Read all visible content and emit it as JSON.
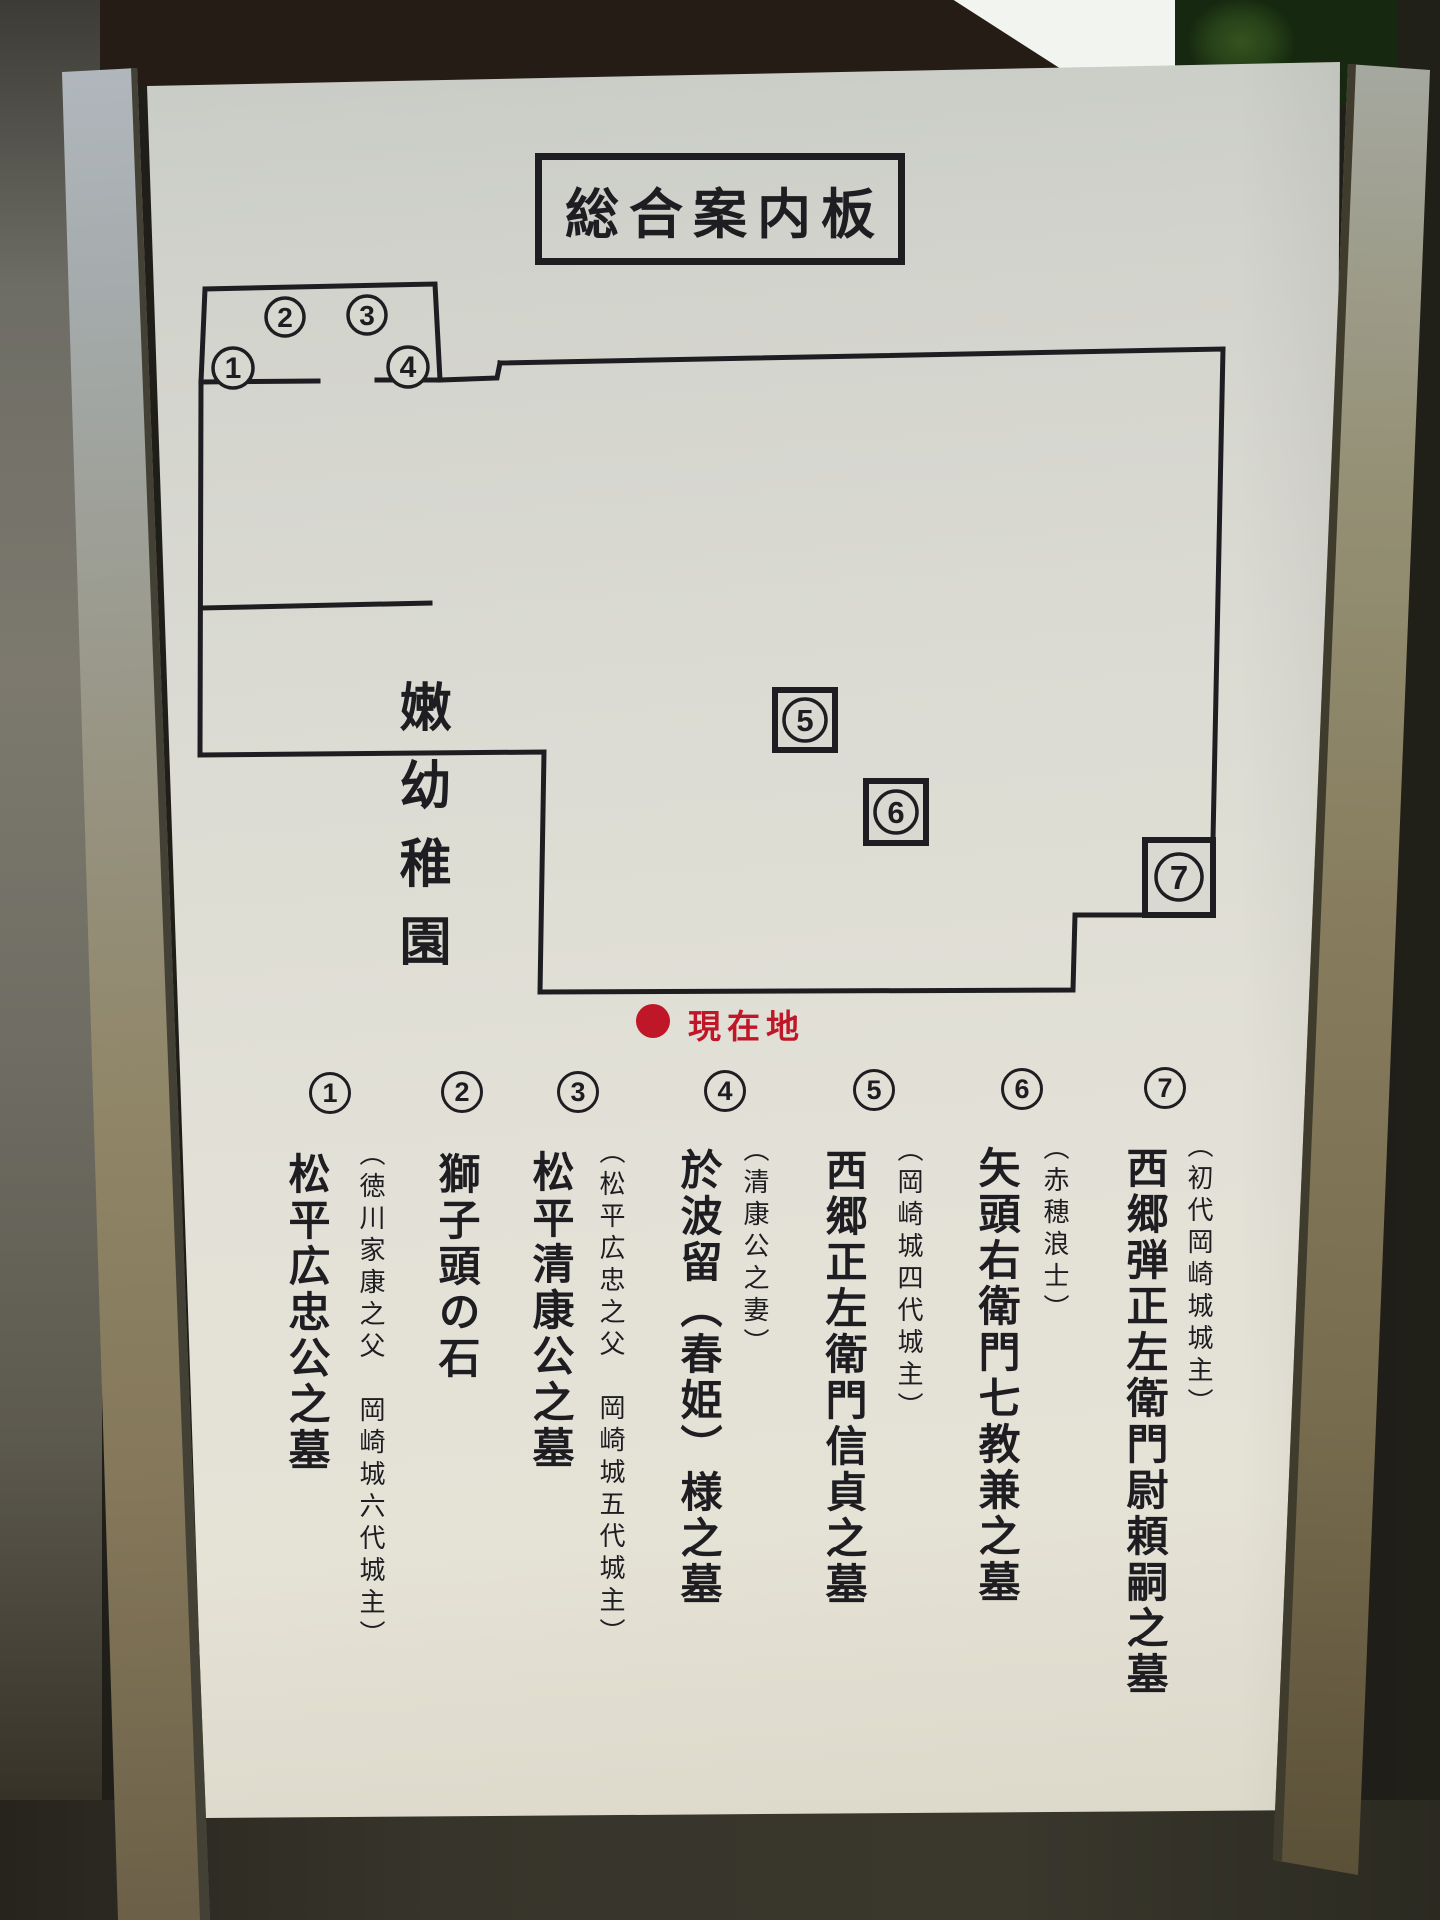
{
  "board": {
    "title": "総合案内板",
    "map": {
      "area_label": "嫩幼稚園",
      "current_location_label": "現在地",
      "markers": [
        "1",
        "2",
        "3",
        "4",
        "5",
        "6",
        "7"
      ]
    },
    "legend": {
      "items": [
        {
          "number": "1",
          "name": "松平広忠公之墓",
          "note": "（徳川家康之父　岡崎城六代城主）"
        },
        {
          "number": "2",
          "name": "獅子頭の石",
          "note": ""
        },
        {
          "number": "3",
          "name": "松平清康公之墓",
          "note": "（松平広忠之父　岡崎城五代城主）"
        },
        {
          "number": "4",
          "name": "於波留（春姫）様之墓",
          "note": "（清康公之妻）"
        },
        {
          "number": "5",
          "name": "西郷正左衛門信貞之墓",
          "note": "（岡崎城四代城主）"
        },
        {
          "number": "6",
          "name": "矢頭右衛門七教兼之墓",
          "note": "（赤穂浪士）"
        },
        {
          "number": "7",
          "name": "西郷弾正左衛門尉頼嗣之墓",
          "note": "（初代岡崎城城主）"
        }
      ]
    },
    "colors": {
      "ink": "#1e1e22",
      "accent_red": "#bf1628",
      "panel": "#dcdacd"
    }
  }
}
